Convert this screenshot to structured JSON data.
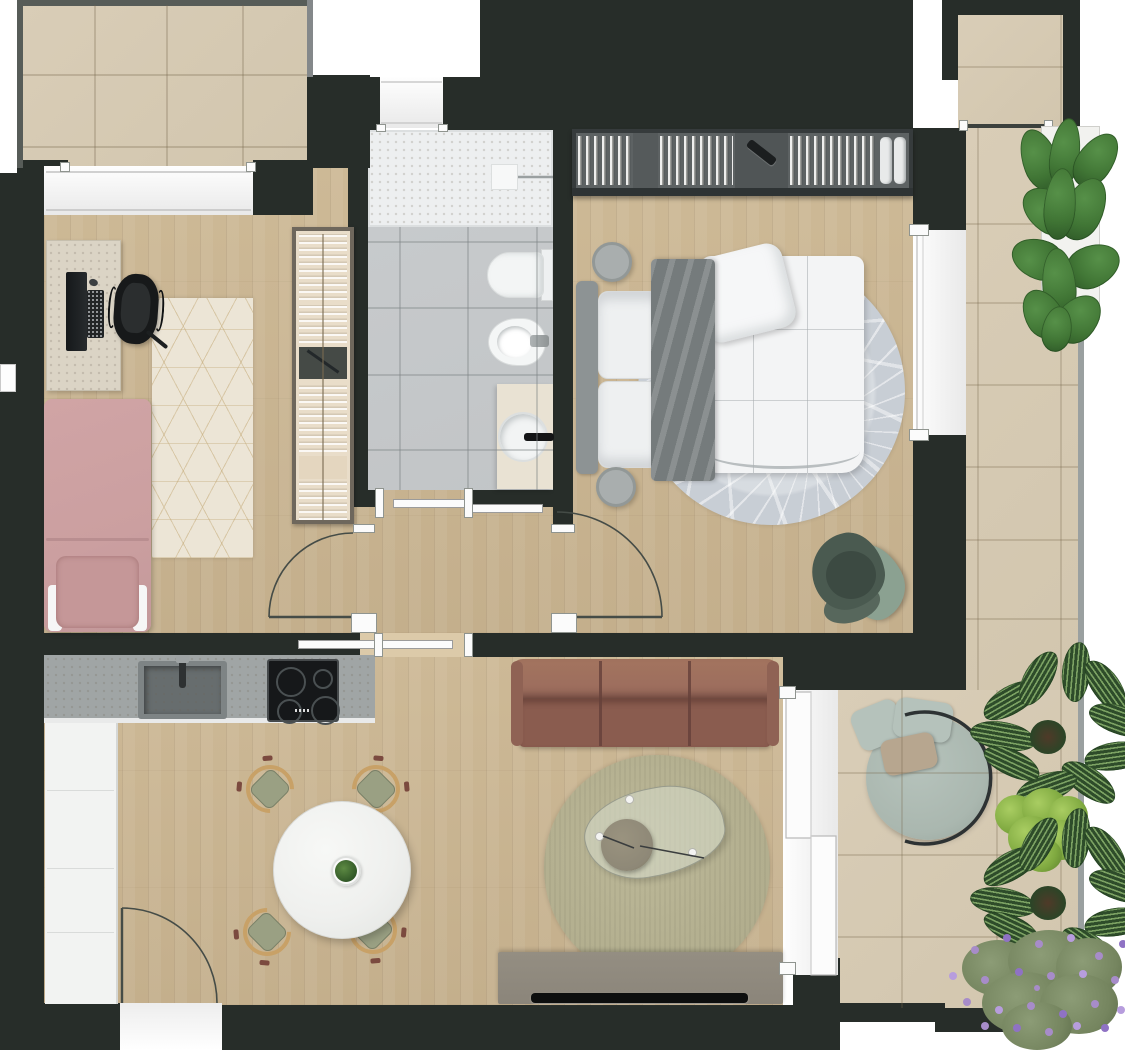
{
  "meta": {
    "description": "Top-down 3D rendered floor plan of a one-bedroom apartment with two terraces",
    "type": "floor-plan-rendering",
    "visible_text": []
  },
  "colors": {
    "wall": "#272d29",
    "woodA": "#cdb996",
    "woodB": "#c4af8c",
    "woodLight": "#dccaa9",
    "balconyTile": "#d2c6ae",
    "balconyTileLight": "#d9cdb7",
    "bathTile": "#c2c5c7",
    "showerTray": "#edeff0",
    "grout": "#8c9294",
    "counter": "#a0a5a5",
    "sinkBasin": "#676d6e",
    "hob": "#16181a",
    "cabinet": "#f2f3f2",
    "white": "#fbfbfb",
    "pink": "#cb9fa0",
    "pinkDark": "#b98e90",
    "officeRug": "#ece5d6",
    "rugLine": "#c3a977",
    "desk": "#dbd4c5",
    "laptop": "#202324",
    "chairBlack": "#17191a",
    "shelf": "#e9ddc9",
    "shelfBox": "#454a46",
    "wardrobeFrame": "#363b3c",
    "wardrobeInner": "#5d6263",
    "towel": "#e8eaea",
    "bedRug": "#c8ced5",
    "headboard": "#8d9394",
    "pillow": "#eef0f1",
    "blanket": "#757b7c",
    "duvet": "#f3f4f5",
    "stool": "#a9aeae",
    "greenChair": "#4a5a50",
    "greenChairArm": "#8ba191",
    "sofaBack": "#9a6b5d",
    "sofaSeat": "#8a5c4f",
    "sofaShadow": "#64403a",
    "livingRug": "#b2ae8e",
    "glass": "#d4d8c6",
    "tray2": "#8e8877",
    "tvStand": "#8b857a",
    "tv": "#0d0e0e",
    "daybed": "#aab7af",
    "daybedPillow": "#b5c2bb",
    "daybedPillowTaupe": "#b7a68f",
    "frameDark": "#2d3233",
    "doorLine": "#454c47",
    "railing": "#9aa0a0",
    "railDark": "#575c58",
    "ficus": "#3f7434",
    "ficusDark": "#2c5526",
    "calatheaDark": "#2e4c2a",
    "calatheaLight": "#7ca263",
    "bush": "#7ea83f",
    "bushLight": "#a9cd62",
    "lavFoliage": "#75855f",
    "lavPurple": "#a78cc9",
    "tableWhite": "#eff0ee",
    "chairSeat": "#9aa083",
    "chairWood": "#c8a167",
    "chairAccent": "#7b4a3f",
    "vanity": "#e9e2d3"
  },
  "rooms": [
    {
      "id": "terrace-top-left",
      "label": "terrace",
      "floor": "beige-tile",
      "items": [
        "tile-grid",
        "dark-railing"
      ]
    },
    {
      "id": "office",
      "label": "office-second-bedroom",
      "floor": "wood",
      "items": [
        "travertine-desk",
        "laptop",
        "keyboard",
        "mouse",
        "black-office-chair",
        "geometric-cream-rug",
        "open-shelf-unit-with-clothes",
        "single-bed-pink"
      ]
    },
    {
      "id": "bathroom",
      "label": "bathroom",
      "floor": "gray-tile",
      "items": [
        "walk-in-shower-tray",
        "shower-window",
        "wall-hung-toilet",
        "bidet",
        "vanity-with-round-sink",
        "sliding-door"
      ]
    },
    {
      "id": "hallway",
      "label": "hallway",
      "floor": "wood",
      "items": [
        "office-door-swing",
        "bedroom-door-swing",
        "bathroom-sliding-door",
        "kitchen-sliding-door"
      ]
    },
    {
      "id": "bedroom",
      "label": "bedroom",
      "floor": "wood",
      "items": [
        "wardrobe-hanging-clothes",
        "folded-towels",
        "round-leaf-pattern-rug",
        "double-bed",
        "gray-headboard",
        "stacked-pillows",
        "gray-throw-blanket",
        "white-duvet",
        "round-side-table",
        "round-foot-stool",
        "green-lounge-chair",
        "balcony-window"
      ]
    },
    {
      "id": "kitchen-dining",
      "label": "kitchen-dining",
      "floor": "wood",
      "items": [
        "gray-counter",
        "undermount-sink",
        "faucet",
        "induction-hob-4-zones",
        "tall-white-cabinet-column",
        "round-marble-dining-table",
        "dining-chair",
        "dining-chair",
        "dining-chair",
        "dining-chair",
        "table-centerpiece-plant",
        "entrance-door-swing"
      ]
    },
    {
      "id": "living",
      "label": "living-room",
      "floor": "wood",
      "items": [
        "three-seat-terracotta-sofa",
        "round-olive-rug",
        "organic-glass-coffee-table",
        "round-tray-table",
        "tv-sideboard",
        "flat-tv",
        "sliding-balcony-door"
      ]
    },
    {
      "id": "balcony-right",
      "label": "balcony",
      "floor": "beige-tile",
      "items": [
        "round-daybed",
        "sage-cushion",
        "sage-cushion",
        "taupe-cushion",
        "glass-railing",
        "ficus-planter",
        "calathea-planter",
        "green-shrub",
        "calathea-planter",
        "lavender-shrub"
      ]
    }
  ],
  "inventory": {
    "dining_chairs": 4,
    "sofa_seats": 3,
    "doors_swing": 3,
    "doors_sliding": 3,
    "windows": 4,
    "balconies": 2,
    "plants": 7,
    "wardrobe_sections": 5
  }
}
